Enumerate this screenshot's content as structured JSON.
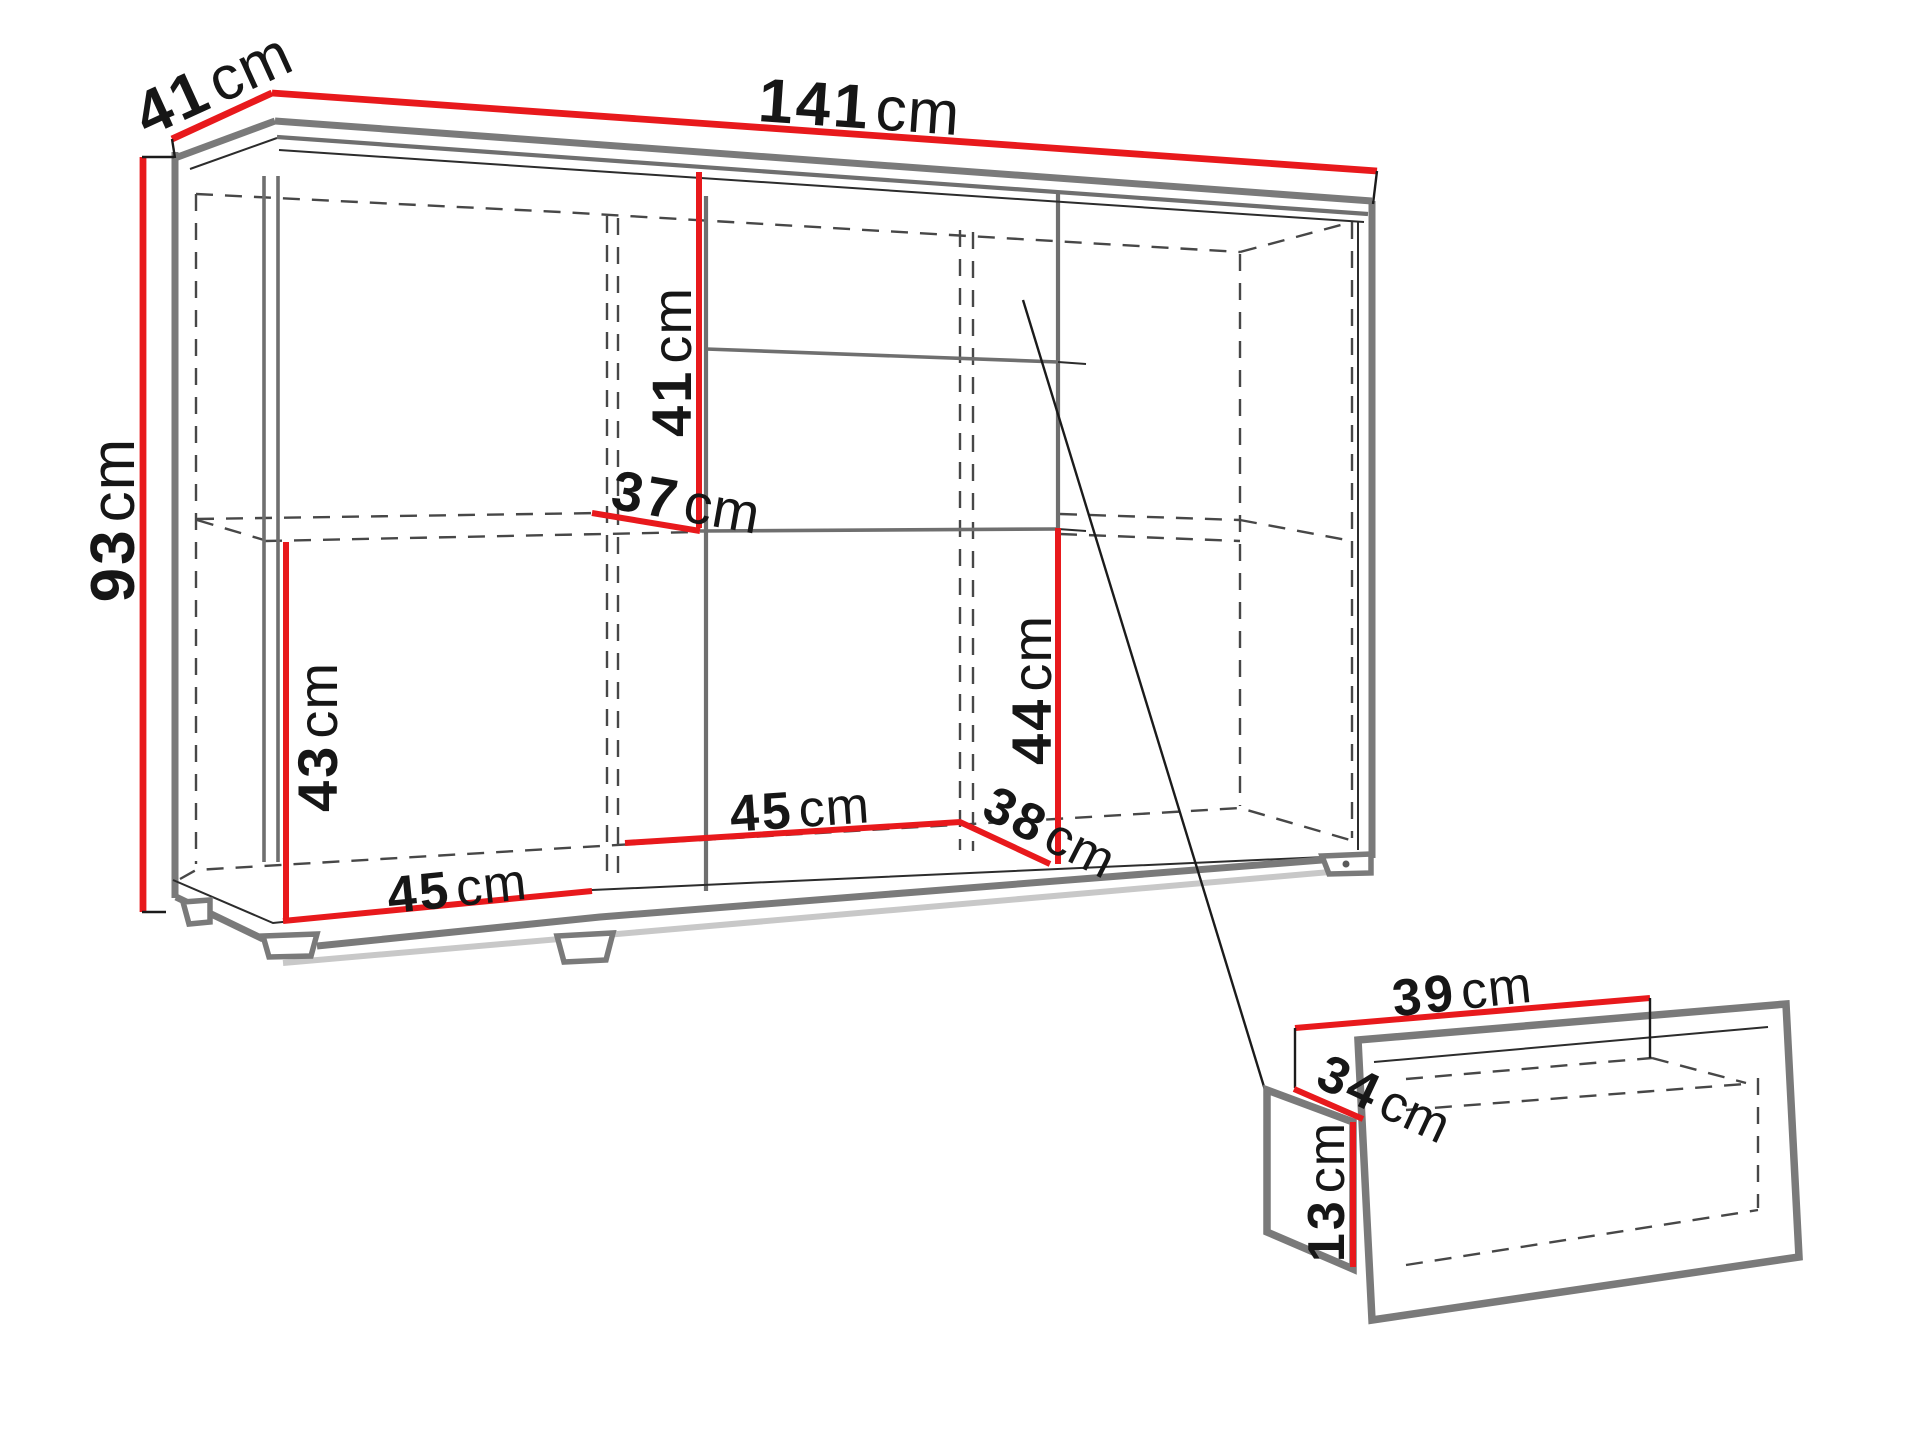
{
  "diagram": {
    "kind": "furniture-dimension-diagram",
    "unit": "cm",
    "accent_color": "#e8191c",
    "outline_color": "#7a7a7a",
    "cabinet": {
      "top_depth": {
        "value": "41",
        "unit": "cm"
      },
      "top_width": {
        "value": "141",
        "unit": "cm"
      },
      "left_height": {
        "value": "93",
        "unit": "cm"
      },
      "upper_compartment": {
        "value": "41",
        "unit": "cm"
      },
      "shelf_depth": {
        "value": "37",
        "unit": "cm"
      },
      "lower_left_height": {
        "value": "43",
        "unit": "cm"
      },
      "left_section_width": {
        "value": "45",
        "unit": "cm"
      },
      "middle_section_width": {
        "value": "45",
        "unit": "cm"
      },
      "bottom_depth": {
        "value": "38",
        "unit": "cm"
      },
      "lower_right_height": {
        "value": "44",
        "unit": "cm"
      }
    },
    "drawer": {
      "width": {
        "value": "39",
        "unit": "cm"
      },
      "depth": {
        "value": "34",
        "unit": "cm"
      },
      "height": {
        "value": "13",
        "unit": "cm"
      }
    }
  }
}
